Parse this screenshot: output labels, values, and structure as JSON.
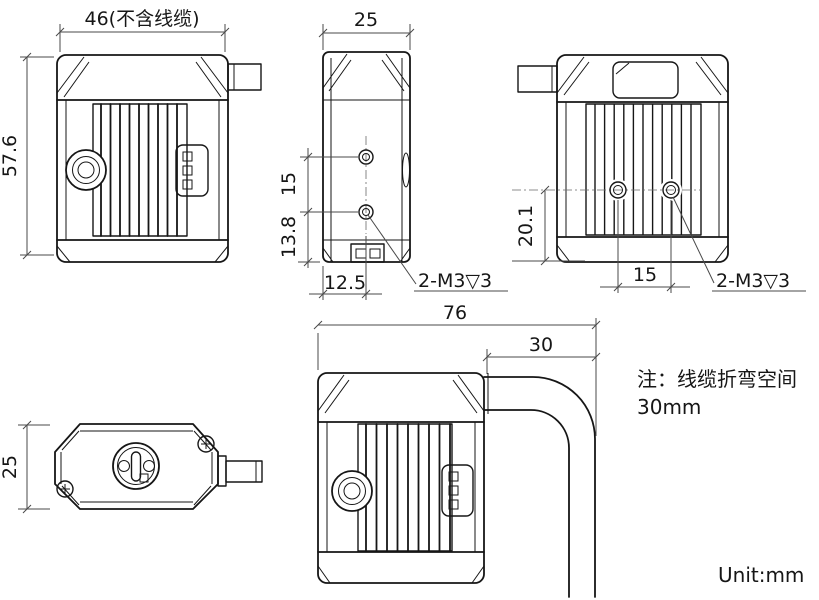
{
  "unit_label": "Unit:mm",
  "note": {
    "line1": "注：线缆折弯空间",
    "line2": "30mm"
  },
  "views": {
    "front": {
      "width_dim": "46(不含线缆)",
      "height_dim": "57.6"
    },
    "bottom": {
      "width_dim": "25",
      "hole_pitch_dim": "15",
      "hole_to_edge_dim": "13.8",
      "hole_center_offset_dim": "12.5",
      "thread_callout": "2-M3▽3"
    },
    "side": {
      "hole_height_dim": "20.1",
      "hole_pitch_dim": "15",
      "thread_callout": "2-M3▽3"
    },
    "top": {
      "depth_dim": "25"
    },
    "front_with_cable": {
      "width_dim": "76",
      "cable_bend_dim": "30"
    }
  },
  "colors": {
    "outline": "#161616",
    "dimension": "#4a4a4a",
    "background": "#ffffff"
  }
}
